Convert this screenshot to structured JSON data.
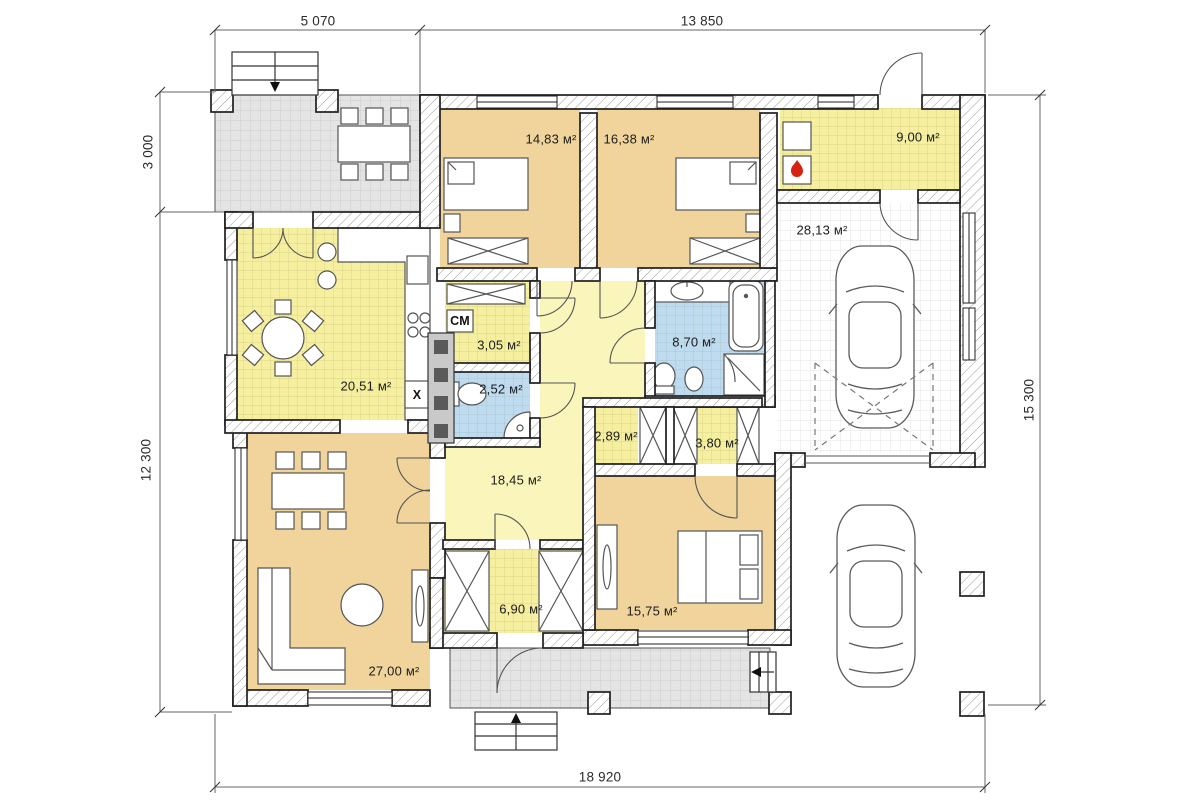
{
  "dimensions": {
    "top_left": "5 070",
    "top_main": "13 850",
    "left_upper": "3 000",
    "left_lower": "12 300",
    "right_side": "15 300",
    "bottom_total": "18 920"
  },
  "rooms": {
    "bedroom1": "14,83 м²",
    "bedroom2": "16,38 м²",
    "boiler_room": "9,00 м²",
    "garage": "28,13 м²",
    "kitchen_dining": "20,51 м²",
    "laundry": "3,05 м²",
    "wc": "2,52 м²",
    "bathroom": "8,70 м²",
    "hall": "18,45 м²",
    "closet1": "2,89 м²",
    "closet2": "3,80 м²",
    "entry_wardrobe": "6,90 м²",
    "bedroom3": "15,75 м²",
    "living_room": "27,00 м²"
  },
  "markers": {
    "washing_machine": "СМ",
    "fridge": "X"
  },
  "colors": {
    "room_tan": "#f0d49c",
    "room_yellow": "#f5ef9f",
    "hall_pale_yellow": "#f9f5bb",
    "room_blue": "#bedbf0",
    "terrace_gray": "#e4e4e4",
    "flame_red": "#d42310",
    "wall_line": "#1f1f1f"
  }
}
